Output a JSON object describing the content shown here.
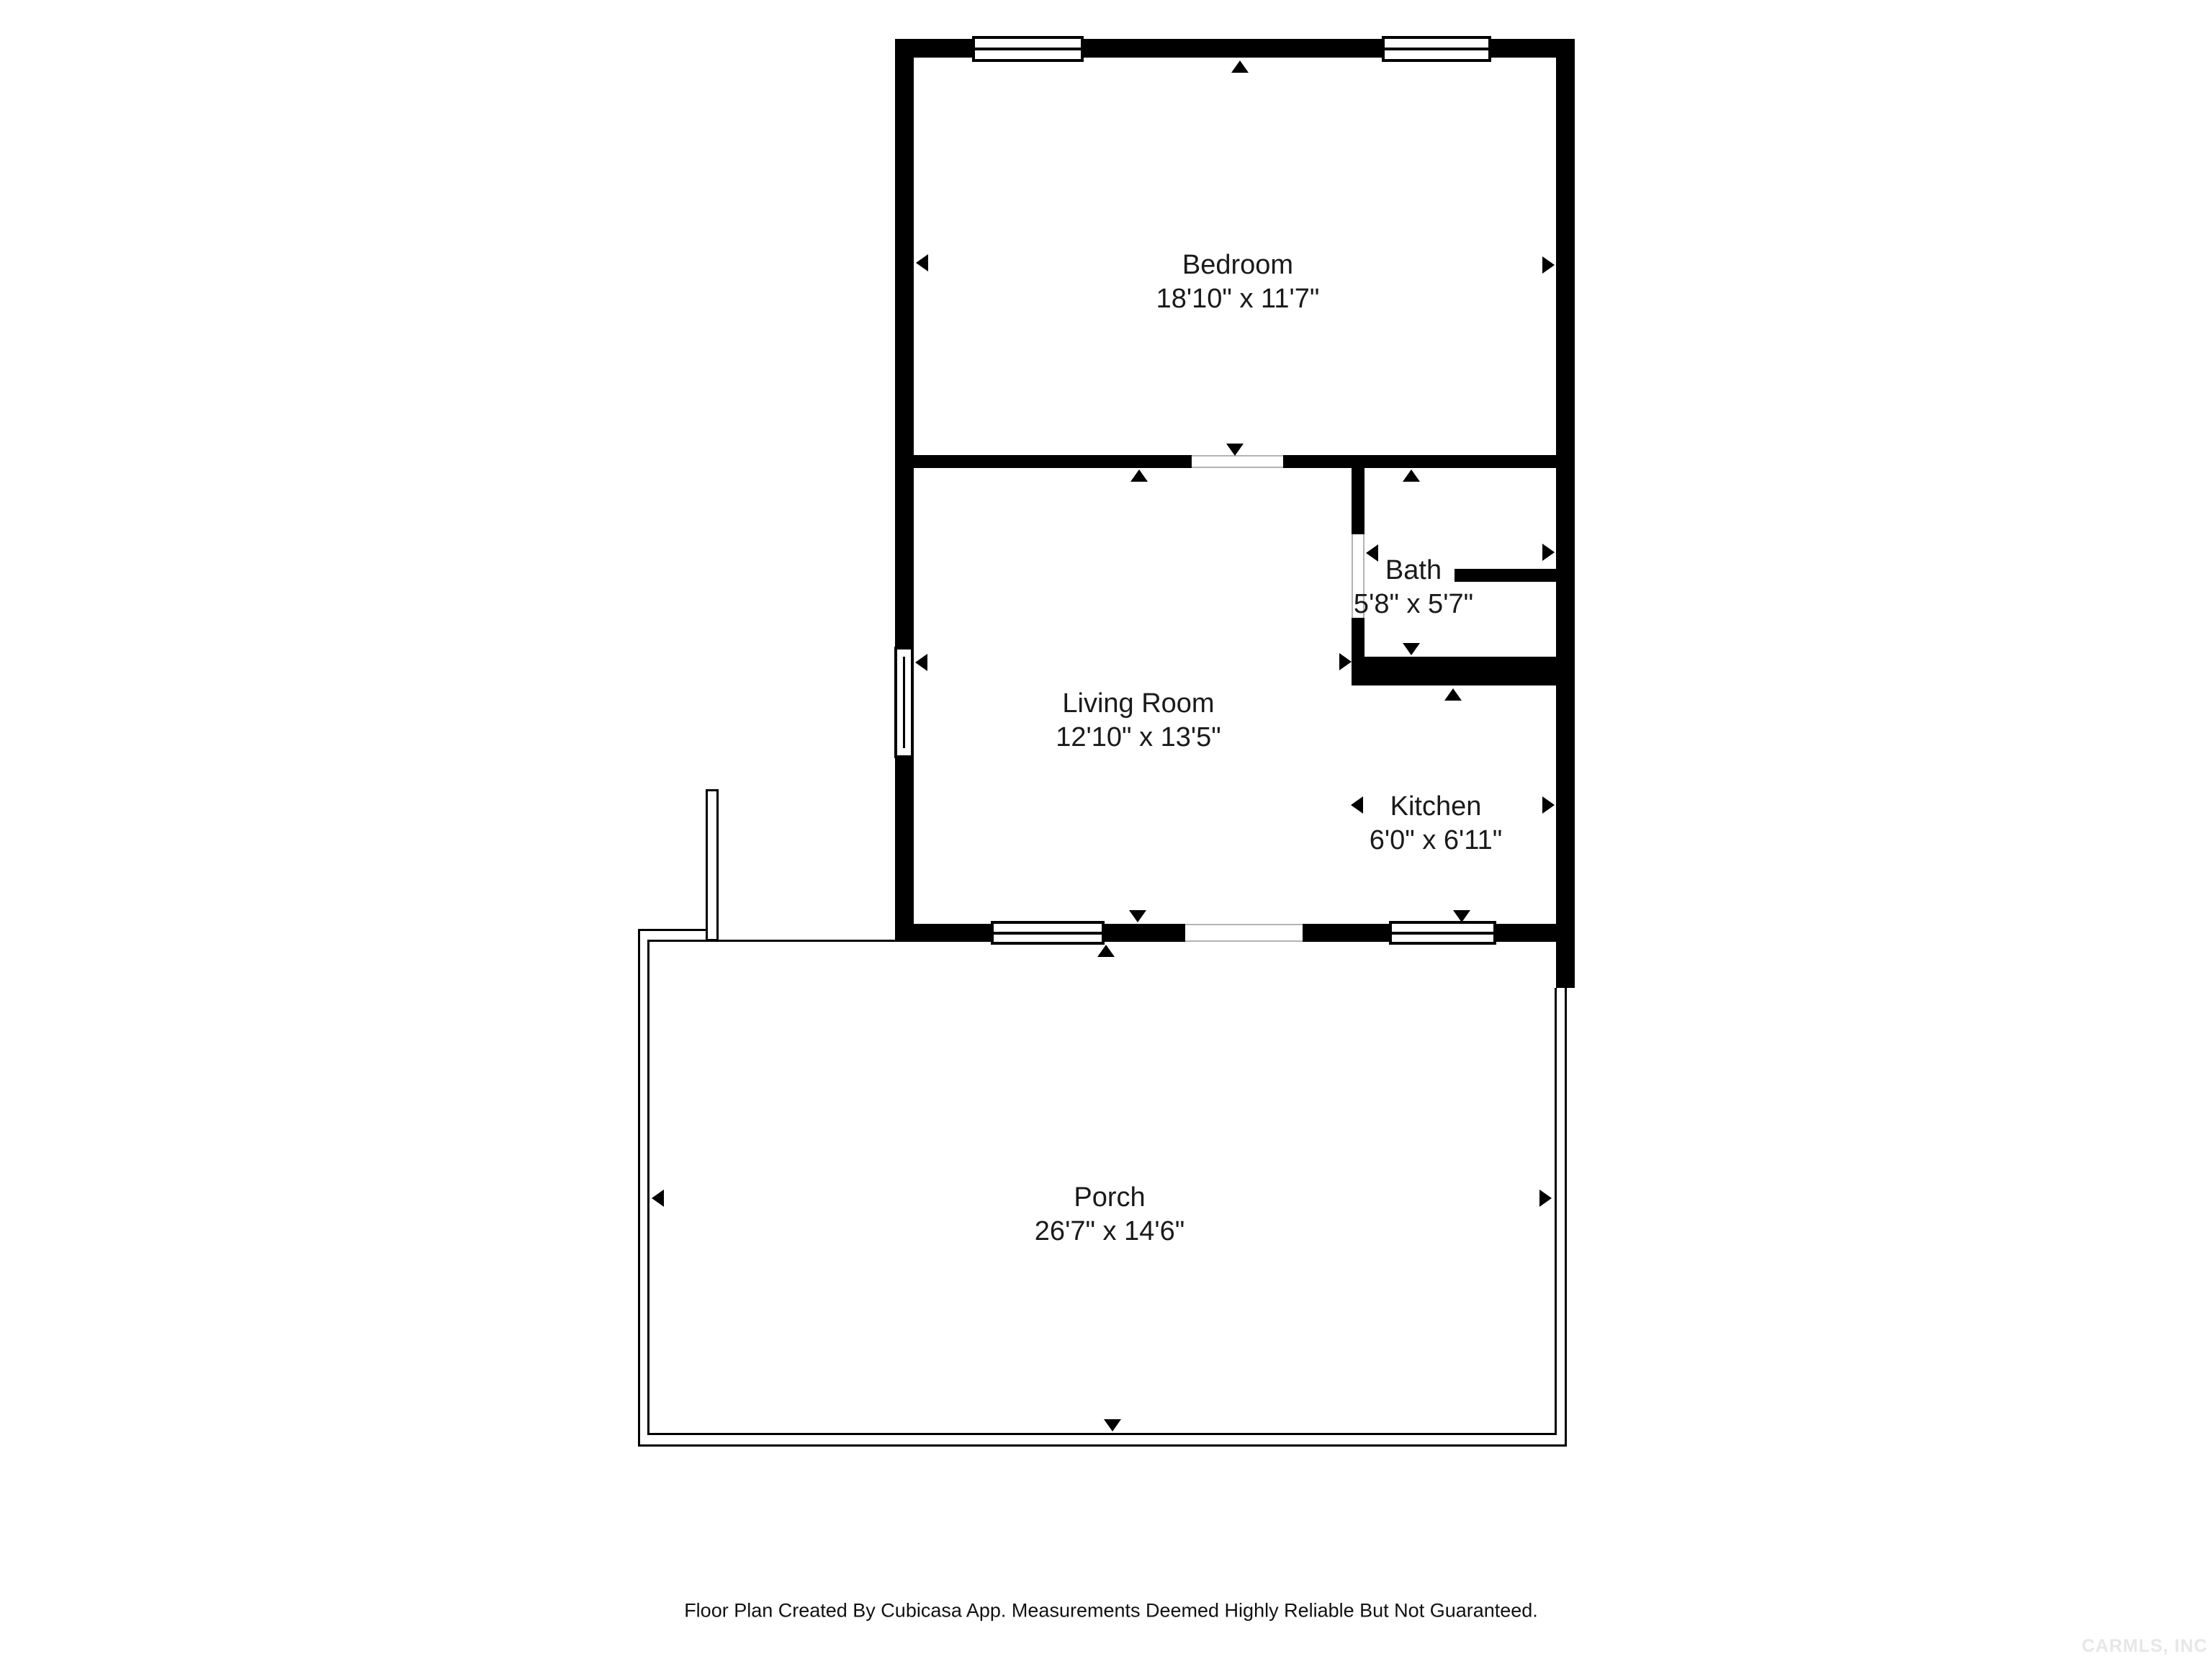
{
  "plan": {
    "type": "floor-plan",
    "source_app": "Cubicasa"
  },
  "rooms": [
    {
      "id": "bedroom",
      "name": "Bedroom",
      "dimensions": "18'10\" x 11'7\""
    },
    {
      "id": "living-room",
      "name": "Living Room",
      "dimensions": "12'10\" x 13'5\""
    },
    {
      "id": "bath",
      "name": "Bath",
      "dimensions": "5'8\" x 5'7\""
    },
    {
      "id": "kitchen",
      "name": "Kitchen",
      "dimensions": "6'0\" x 6'11\""
    },
    {
      "id": "porch",
      "name": "Porch",
      "dimensions": "26'7\" x 14'6\""
    }
  ],
  "footer": {
    "disclaimer": "Floor Plan Created By Cubicasa App. Measurements Deemed Highly Reliable But Not Guaranteed."
  },
  "watermark": {
    "text": "CARMLS, INC"
  },
  "icons": {
    "dimension-arrow": "small black triangle marking measured extents of each room",
    "window": "white rectangle with center line embedded in wall",
    "door-opening": "white gap in wall with thin gray edges"
  },
  "colors": {
    "wall": "#000000",
    "background": "#ffffff",
    "label_text": "#1a1a1a",
    "opening_edge": "#b3b3b3",
    "watermark": "#e7e7e7"
  }
}
